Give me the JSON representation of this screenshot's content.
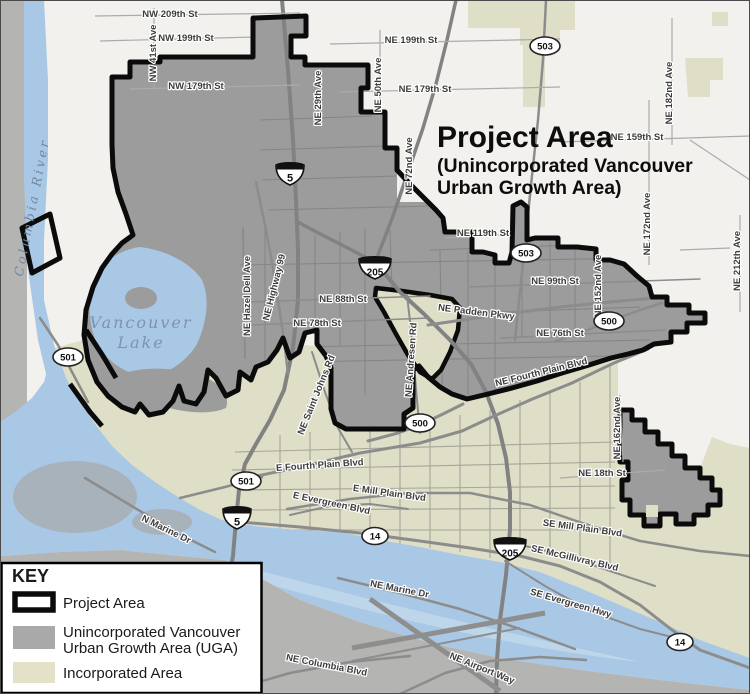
{
  "title": {
    "line1": "Project Area",
    "line2": "(Unincorporated Vancouver",
    "line3": "Urban Growth Area)"
  },
  "legend": {
    "heading": "KEY",
    "items": [
      {
        "label": "Project Area",
        "swatch": "project-area-outline"
      },
      {
        "label_line1": "Unincorporated Vancouver",
        "label_line2": "Urban Growth Area (UGA)",
        "swatch": "uga-gray"
      },
      {
        "label": "Incorporated Area",
        "swatch": "incorporated-beige"
      }
    ]
  },
  "water_labels": {
    "river": "Columbia River",
    "lake_line1": "Vancouver",
    "lake_line2": "Lake"
  },
  "street_labels": [
    {
      "text": "NW 209th St"
    },
    {
      "text": "NW 199th St"
    },
    {
      "text": "NE 199th St"
    },
    {
      "text": "NW 179th St"
    },
    {
      "text": "NE 179th St"
    },
    {
      "text": "NW 41st Ave"
    },
    {
      "text": "NE 29th Ave"
    },
    {
      "text": "NE 50th Ave"
    },
    {
      "text": "NE 72nd Ave"
    },
    {
      "text": "NE 182nd Ave"
    },
    {
      "text": "NE 159th St"
    },
    {
      "text": "NE 172nd Ave"
    },
    {
      "text": "NE 212th Ave"
    },
    {
      "text": "NE 119th St"
    },
    {
      "text": "NE 99th St"
    },
    {
      "text": "NE 152nd Ave"
    },
    {
      "text": "NE Padden Pkwy"
    },
    {
      "text": "NE 88th St"
    },
    {
      "text": "NE 78th St"
    },
    {
      "text": "NE 76th St"
    },
    {
      "text": "NE Hazel Dell Ave"
    },
    {
      "text": "NE Highway 99"
    },
    {
      "text": "NE Andresen Rd"
    },
    {
      "text": "NE Saint Johns Rd"
    },
    {
      "text": "NE Fourth Plain Blvd"
    },
    {
      "text": "NE 162nd Ave"
    },
    {
      "text": "E Fourth Plain Blvd"
    },
    {
      "text": "E Mill Plain Blvd"
    },
    {
      "text": "E Evergreen Blvd"
    },
    {
      "text": "SE Mill Plain Blvd"
    },
    {
      "text": "SE McGillivray Blvd"
    },
    {
      "text": "SE Evergreen Hwy"
    },
    {
      "text": "NE 18th St"
    },
    {
      "text": "N Marine Dr"
    },
    {
      "text": "NE Marine Dr"
    },
    {
      "text": "NE Airport Way"
    },
    {
      "text": "NE Columbia Blvd"
    }
  ],
  "highway_shields": [
    {
      "type": "interstate",
      "number": "5"
    },
    {
      "type": "interstate",
      "number": "205"
    },
    {
      "type": "interstate",
      "number": "5"
    },
    {
      "type": "interstate",
      "number": "205"
    },
    {
      "type": "oval",
      "number": "503"
    },
    {
      "type": "oval",
      "number": "503"
    },
    {
      "type": "oval",
      "number": "500"
    },
    {
      "type": "oval",
      "number": "500"
    },
    {
      "type": "oval",
      "number": "501"
    },
    {
      "type": "oval",
      "number": "501"
    },
    {
      "type": "oval",
      "number": "14"
    },
    {
      "type": "oval",
      "number": "14"
    }
  ],
  "colors": {
    "outside": "#f2f1ee",
    "uga_gray": "#9c9c9c",
    "incorporated": "#dfdec6",
    "water": "#a9c8e6",
    "river_streak": "#c2d8ea",
    "portland_gray": "#b4b4b2",
    "island_gray": "#a7b2bb",
    "boundary": "#0b0b0b",
    "label": "#3d3d3d",
    "water_label": "#6f86a4",
    "legend_gray": "#a9a9a9",
    "legend_beige": "#e3e2c9"
  }
}
